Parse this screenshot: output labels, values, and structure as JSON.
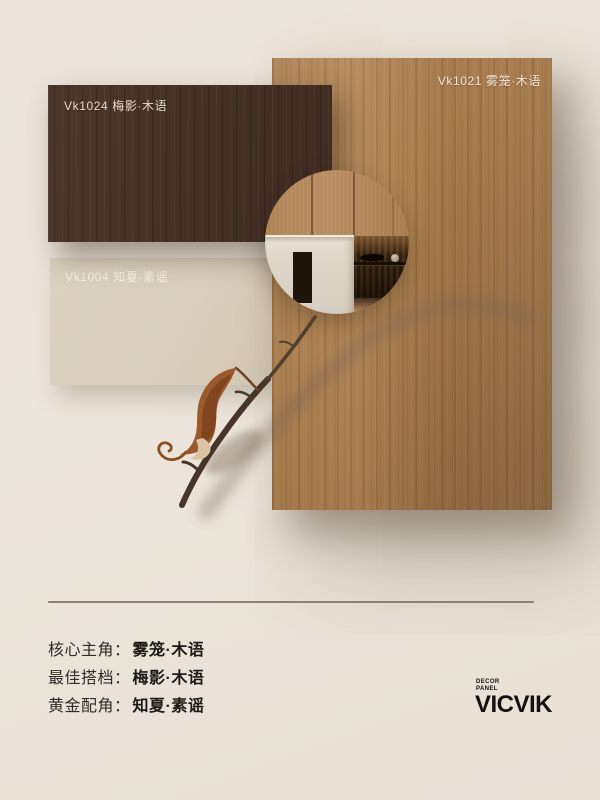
{
  "colors": {
    "background": "#eae2d8",
    "wood_panel": "#ab8052",
    "dark_panel": "#46322a",
    "beige_panel": "#d9cfbc",
    "divider": "#8b8177",
    "text_dark": "#22201c",
    "panel_label_light": "#f2e9d9"
  },
  "panels": {
    "wood": {
      "code_label": "Vk1021 雾笼·木语"
    },
    "dark": {
      "code_label": "Vk1024 梅影·木语"
    },
    "beige": {
      "code_label": "Vk1004 知夏·素谣"
    }
  },
  "footer": {
    "rows": [
      {
        "label": "核心主角：",
        "value": "雾笼·木语"
      },
      {
        "label": "最佳搭档：",
        "value": "梅影·木语"
      },
      {
        "label": "黄金配角：",
        "value": "知夏·素谣"
      }
    ],
    "brand": {
      "tagline_lines": [
        "DECOR",
        "PANEL"
      ],
      "name": "VICVIK"
    }
  }
}
